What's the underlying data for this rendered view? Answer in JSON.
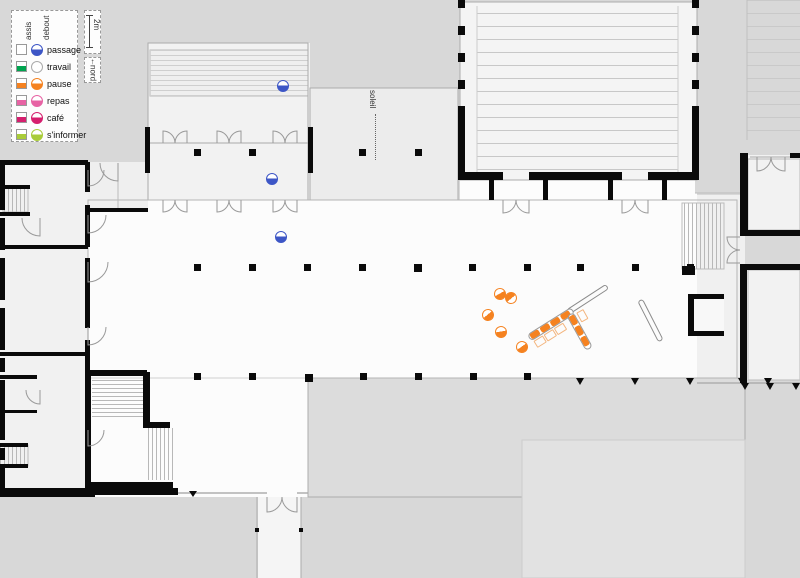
{
  "legend": {
    "columns": [
      {
        "label": "assis"
      },
      {
        "label": "debout"
      }
    ],
    "items": [
      {
        "label": "passage",
        "color": "#3d56c6",
        "assis": false,
        "debout": true
      },
      {
        "label": "travail",
        "color": "#00a44f",
        "assis": true,
        "debout": false
      },
      {
        "label": "pause",
        "color": "#f58220",
        "assis": true,
        "debout": true
      },
      {
        "label": "repas",
        "color": "#e763a4",
        "assis": true,
        "debout": true
      },
      {
        "label": "café",
        "color": "#d51f6e",
        "assis": true,
        "debout": true
      },
      {
        "label": "s'informer",
        "color": "#a9cc39",
        "assis": true,
        "debout": true
      }
    ]
  },
  "scale_bar": {
    "label": "2m"
  },
  "compass": {
    "label": "nord",
    "arrow": "↑"
  },
  "sun": {
    "label": "soleil"
  },
  "people": [
    {
      "activity": "passage",
      "posture": "debout",
      "x": 283,
      "y": 86,
      "rot": 0
    },
    {
      "activity": "passage",
      "posture": "debout",
      "x": 272,
      "y": 179,
      "rot": 0
    },
    {
      "activity": "passage",
      "posture": "debout",
      "x": 281,
      "y": 237,
      "rot": 0
    },
    {
      "activity": "pause",
      "posture": "debout",
      "x": 500,
      "y": 294,
      "rot": -30
    },
    {
      "activity": "pause",
      "posture": "debout",
      "x": 511,
      "y": 298,
      "rot": 140
    },
    {
      "activity": "pause",
      "posture": "debout",
      "x": 488,
      "y": 315,
      "rot": -40
    },
    {
      "activity": "pause",
      "posture": "debout",
      "x": 501,
      "y": 332,
      "rot": -10
    },
    {
      "activity": "pause",
      "posture": "debout",
      "x": 522,
      "y": 347,
      "rot": -35
    }
  ],
  "furniture": {
    "rods": [
      {
        "x": 568,
        "y": 309,
        "len": 47,
        "angle": -33
      },
      {
        "x": 640,
        "y": 297,
        "len": 46,
        "angle": 63
      }
    ],
    "benches": [
      {
        "x": 529,
        "y": 334,
        "angle": -32,
        "seats": 4,
        "ghosts": 3,
        "ghost_side": 1
      },
      {
        "x": 570,
        "y": 310,
        "angle": 61,
        "seats": 3,
        "ghosts": 1,
        "ghost_side": -1
      }
    ]
  }
}
